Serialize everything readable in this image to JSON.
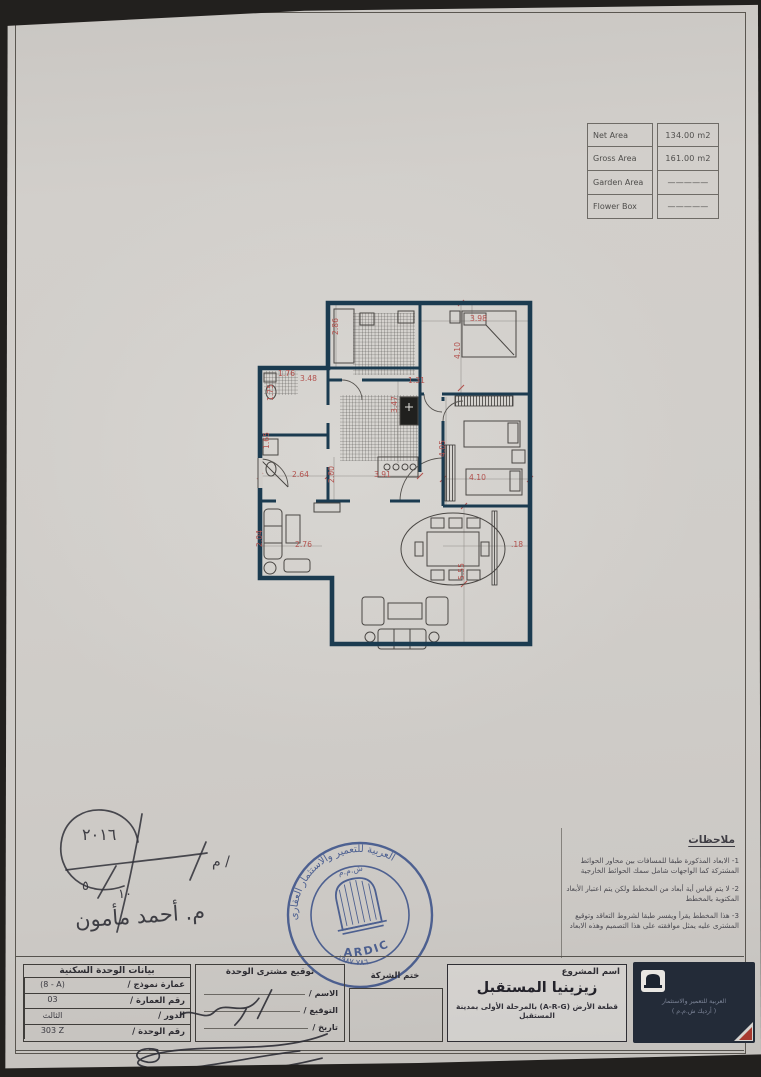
{
  "colors": {
    "wall": "#1b3b50",
    "dim_red": "#b3524e",
    "stamp_blue": "#4a67b2",
    "paper": "#d2cfcb",
    "logo_bg": "#232b38"
  },
  "area_table": {
    "rows": [
      {
        "label": "Net Area",
        "value": "134.00 m2"
      },
      {
        "label": "Gross Area",
        "value": "161.00 m2"
      },
      {
        "label": "Garden Area",
        "value": "—————"
      },
      {
        "label": "Flower Box",
        "value": "—————"
      }
    ]
  },
  "notes": {
    "title": "ملاحظات",
    "items": [
      "1- الابعاد المذكورة طبقا للمسافات بين محاور الحوائط المشتركة كما الواجهات شامل سمك الحوائط الخارجية",
      "2- لا يتم قياس أية أبعاد من المخطط ولكن يتم اعتبار الأبعاد المكتوبة بالمخطط",
      "3- هذا المخطط يقرأ ويفسر طبقا لشروط التعاقد وتوقيع المشترى عليه يمثل موافقته على هذا التصميم وهذه الابعاد"
    ]
  },
  "handwriting": {
    "year": "٢٠١٦",
    "num_left": "٥",
    "num_right": "١٠",
    "prefix": "م /",
    "name": "م. أحمد مأمون"
  },
  "stamp": {
    "ring_text": "العربية للتعمير والاستثمار العقارى",
    "inner_top": "ش.م.م",
    "ring_bottom": "٧٨٦ ١٩٨٧",
    "brand": "ARDIC"
  },
  "bottom": {
    "unit_table": {
      "title": "بيانات الوحدة السكنية",
      "rows": [
        {
          "label": "عمارة نموذج /",
          "value": "(8 - A)"
        },
        {
          "label": "رقم العمارة /",
          "value": "03"
        },
        {
          "label": "الدور        /",
          "value": "الثالث"
        },
        {
          "label": "رقم الوحدة /",
          "value": "303 Z"
        }
      ]
    },
    "signature_box": {
      "title": "توقيع مشترى الوحدة",
      "fields": [
        "الاسم /",
        "التوقيع /",
        "تاريخ /"
      ]
    },
    "stamp_box": {
      "label": "ختم الشركة"
    },
    "project_box": {
      "label": "اسم المشروع",
      "name": "زيزينيا المستقبل",
      "description": "قطعة الأرض (A-R-G) بالمرحلة الأولى بمدينة المستقبل"
    },
    "logo_box": {
      "line1": "العربية للتعمير والاستثمار",
      "line2": "( أرديك ش.م.م )"
    }
  },
  "floorplan": {
    "dimensions": [
      {
        "t": "2.86",
        "x": 88,
        "y": 38,
        "r": -90
      },
      {
        "t": "3.98",
        "x": 220,
        "y": 24,
        "r": 0
      },
      {
        "t": "4.10",
        "x": 210,
        "y": 62,
        "r": -90
      },
      {
        "t": "1.76",
        "x": 28,
        "y": 79,
        "r": 0
      },
      {
        "t": "3.48",
        "x": 50,
        "y": 84,
        "r": 0
      },
      {
        "t": "1.31",
        "x": 158,
        "y": 86,
        "r": 0
      },
      {
        "t": "1.75",
        "x": 23,
        "y": 104,
        "r": -90
      },
      {
        "t": "3.47",
        "x": 147,
        "y": 116,
        "r": -90
      },
      {
        "t": "1.65",
        "x": 19,
        "y": 152,
        "r": -90
      },
      {
        "t": "4.05",
        "x": 195,
        "y": 160,
        "r": -90
      },
      {
        "t": "2.64",
        "x": 42,
        "y": 180,
        "r": 0
      },
      {
        "t": "2.00",
        "x": 84,
        "y": 186,
        "r": -90
      },
      {
        "t": "3.91",
        "x": 124,
        "y": 180,
        "r": 0
      },
      {
        "t": "4.10",
        "x": 219,
        "y": 183,
        "r": 0
      },
      {
        "t": "2.76",
        "x": 45,
        "y": 250,
        "r": 0
      },
      {
        "t": "2.04",
        "x": 12,
        "y": 250,
        "r": -90
      },
      {
        "t": "5.55",
        "x": 214,
        "y": 283,
        "r": -90
      },
      {
        "t": ".18",
        "x": 261,
        "y": 250,
        "r": 0
      }
    ]
  }
}
